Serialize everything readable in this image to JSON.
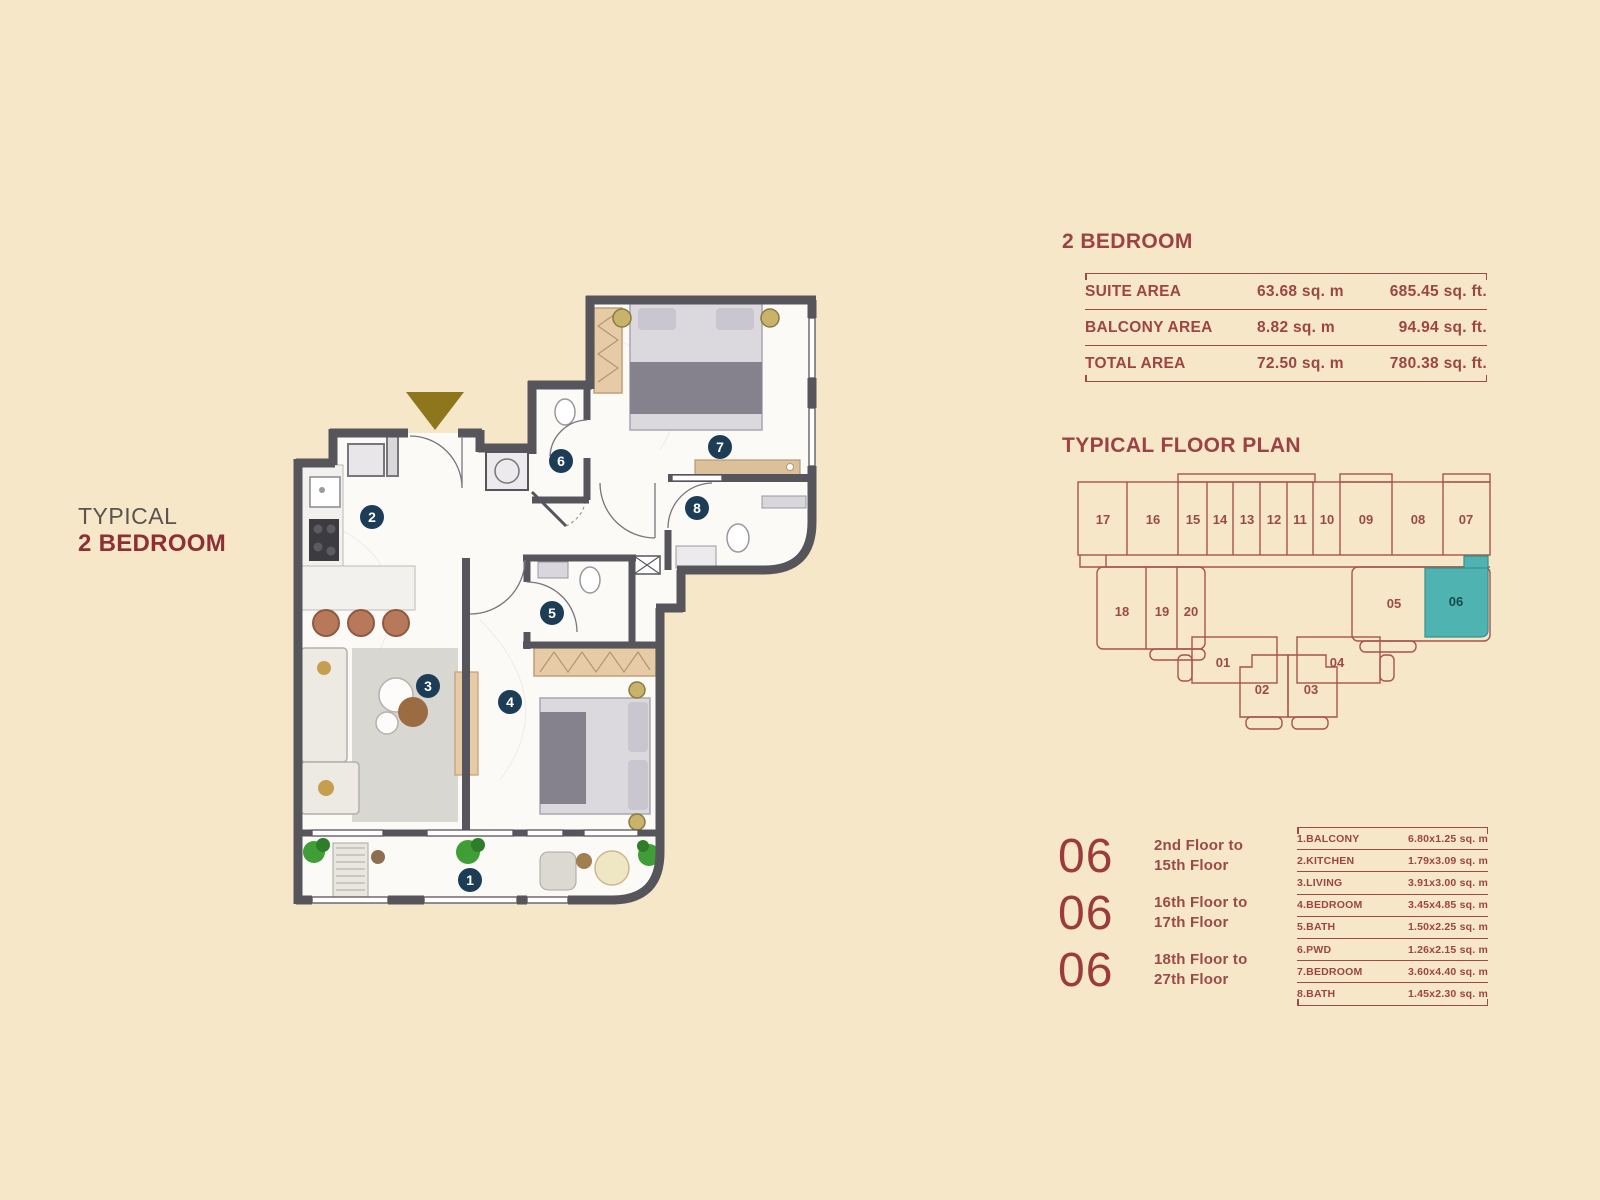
{
  "page": {
    "background": "#f6e7c8"
  },
  "left_label": {
    "line1": "TYPICAL",
    "line2": "2 BEDROOM"
  },
  "area_panel": {
    "title": "2 BEDROOM",
    "rows": [
      {
        "label": "SUITE AREA",
        "metric": "63.68 sq. m",
        "imperial": "685.45 sq. ft."
      },
      {
        "label": "BALCONY AREA",
        "metric": "8.82 sq. m",
        "imperial": "94.94 sq. ft."
      },
      {
        "label": "TOTAL AREA",
        "metric": "72.50 sq. m",
        "imperial": "780.38 sq. ft."
      }
    ]
  },
  "key_plan": {
    "title": "TYPICAL FLOOR PLAN",
    "highlighted_unit": "06",
    "highlight_color": "#4fb4b1",
    "line_color": "#a6544c",
    "units": [
      "17",
      "16",
      "15",
      "14",
      "13",
      "12",
      "11",
      "10",
      "09",
      "08",
      "07",
      "18",
      "19",
      "20",
      "05",
      "06",
      "01",
      "02",
      "03",
      "04"
    ]
  },
  "floors": {
    "unit": "06",
    "ranges": [
      {
        "line1": "2nd Floor to",
        "line2": "15th Floor"
      },
      {
        "line1": "16th Floor to",
        "line2": "17th Floor"
      },
      {
        "line1": "18th Floor to",
        "line2": "27th Floor"
      }
    ]
  },
  "dimensions": {
    "rows": [
      {
        "label": "1.BALCONY",
        "value": "6.80x1.25 sq. m"
      },
      {
        "label": "2.KITCHEN",
        "value": "1.79x3.09 sq. m"
      },
      {
        "label": "3.LIVING",
        "value": "3.91x3.00 sq. m"
      },
      {
        "label": "4.BEDROOM",
        "value": "3.45x4.85 sq. m"
      },
      {
        "label": "5.BATH",
        "value": "1.50x2.25 sq. m"
      },
      {
        "label": "6.PWD",
        "value": "1.26x2.15 sq. m"
      },
      {
        "label": "7.BEDROOM",
        "value": "3.60x4.40 sq. m"
      },
      {
        "label": "8.BATH",
        "value": "1.45x2.30 sq. m"
      }
    ]
  },
  "floorplan": {
    "badges": [
      "1",
      "2",
      "3",
      "4",
      "5",
      "6",
      "7",
      "8"
    ],
    "badge_color": "#1d3c56",
    "wall_color": "#56555b",
    "entry_arrow_color": "#8e761d"
  }
}
